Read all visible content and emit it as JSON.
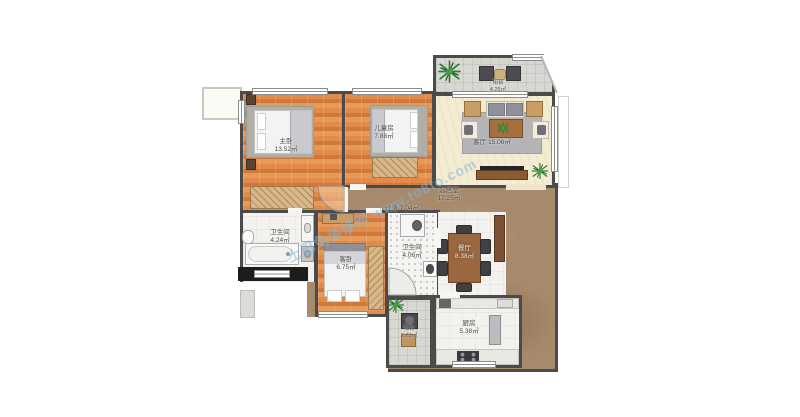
{
  "palette": {
    "wood_floor": "#dd8244",
    "marble_floor": "#a78a6b",
    "living_floor": "#f4ebd3",
    "wall": "#4b4b4b",
    "watermark_blue": "#7fb6d9"
  },
  "watermark": {
    "text": "土巴兔装修网 www.to8to.com"
  },
  "rooms": {
    "master_bedroom": {
      "name": "主卧",
      "area": "13.52㎡"
    },
    "children_room": {
      "name": "儿童房",
      "area": "7.88㎡"
    },
    "living_room": {
      "name": "客厅",
      "area": "15.06㎡"
    },
    "balcony_top": {
      "name": "阳台",
      "area": "4.25㎡"
    },
    "hall": {
      "name": "起居室",
      "area": "17.25㎡"
    },
    "corridor": {
      "name": "过道",
      "area": "7.04㎡"
    },
    "bathroom_1": {
      "name": "卫生间",
      "area": "4.24㎡"
    },
    "bathroom_2": {
      "name": "卫生间",
      "area": "4.06㎡"
    },
    "guest_bedroom": {
      "name": "客卧",
      "area": "6.75㎡"
    },
    "dining_room": {
      "name": "餐厅",
      "area": "8.38㎡"
    },
    "kitchen": {
      "name": "厨房",
      "area": "5.38㎡"
    },
    "balcony_bottom": {
      "name": "阳台",
      "area": "2.63㎡"
    }
  }
}
